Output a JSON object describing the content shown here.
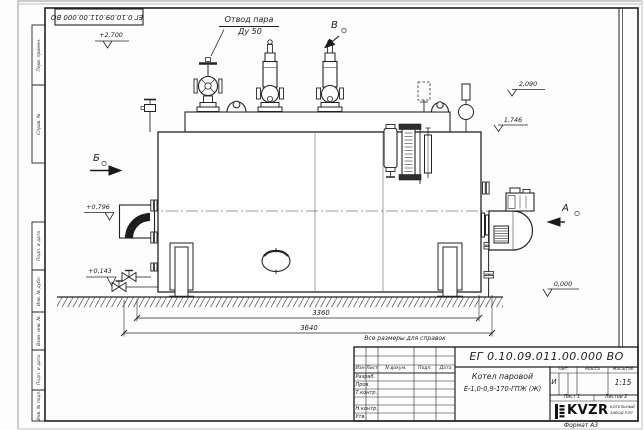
{
  "sheet": {
    "doc_number_stamp": "ЕГ 0.10.09.011.00.000 ВО",
    "format_note": "Формат А3"
  },
  "margin_stamps": {
    "top": [
      "Перв. примен.",
      "Справ. №"
    ],
    "bottom": [
      "Подп. и дата",
      "Инв. № дубл.",
      "Взам. инв. №",
      "Подп. и дата",
      "Инв. № подл."
    ]
  },
  "drawing": {
    "callout": {
      "line1": "Отвод пара",
      "line2": "Ду 50"
    },
    "view_labels": {
      "b": "Б",
      "v": "В",
      "a": "А"
    },
    "elevations": {
      "top": "+2,700",
      "right_upper": "2,090",
      "right_lower": "1,746",
      "left_upper": "+0,796",
      "left_lower": "+0,143",
      "ground": "0,000"
    },
    "dimensions": {
      "length_inner": "3360",
      "length_overall": "3640"
    },
    "reference_note": "Все размеры для справок"
  },
  "title_block": {
    "doc_number": "ЕГ 0.10.09.011.00.000 ВО",
    "product_name": "Котел паровой",
    "product_model": "Е-1,0-0,9-170-ГПЖ (Ж)",
    "header_cols": {
      "izm": "Изм",
      "list": "Лист",
      "ndoc": "N докум.",
      "podp": "Подп.",
      "data": "Дата"
    },
    "signature_rows": {
      "razrab": "Разраб.",
      "prov": "Пров.",
      "tkontr": "Т.контр.",
      "nkontr": "Н.контр.",
      "utv": "Утв."
    },
    "props": {
      "lit_label": "Лит.",
      "mass_label": "Масса",
      "scale_label": "Масштаб",
      "lit_value": "И",
      "scale_value": "1:15"
    },
    "sheet_info": {
      "sheet": "Лист 1",
      "sheets": "Листов 2"
    },
    "company": {
      "logo_text": "KVZR",
      "name_line1": "КОТЕЛЬНЫЙ",
      "name_line2": "ЗАВОД РЭП"
    }
  }
}
